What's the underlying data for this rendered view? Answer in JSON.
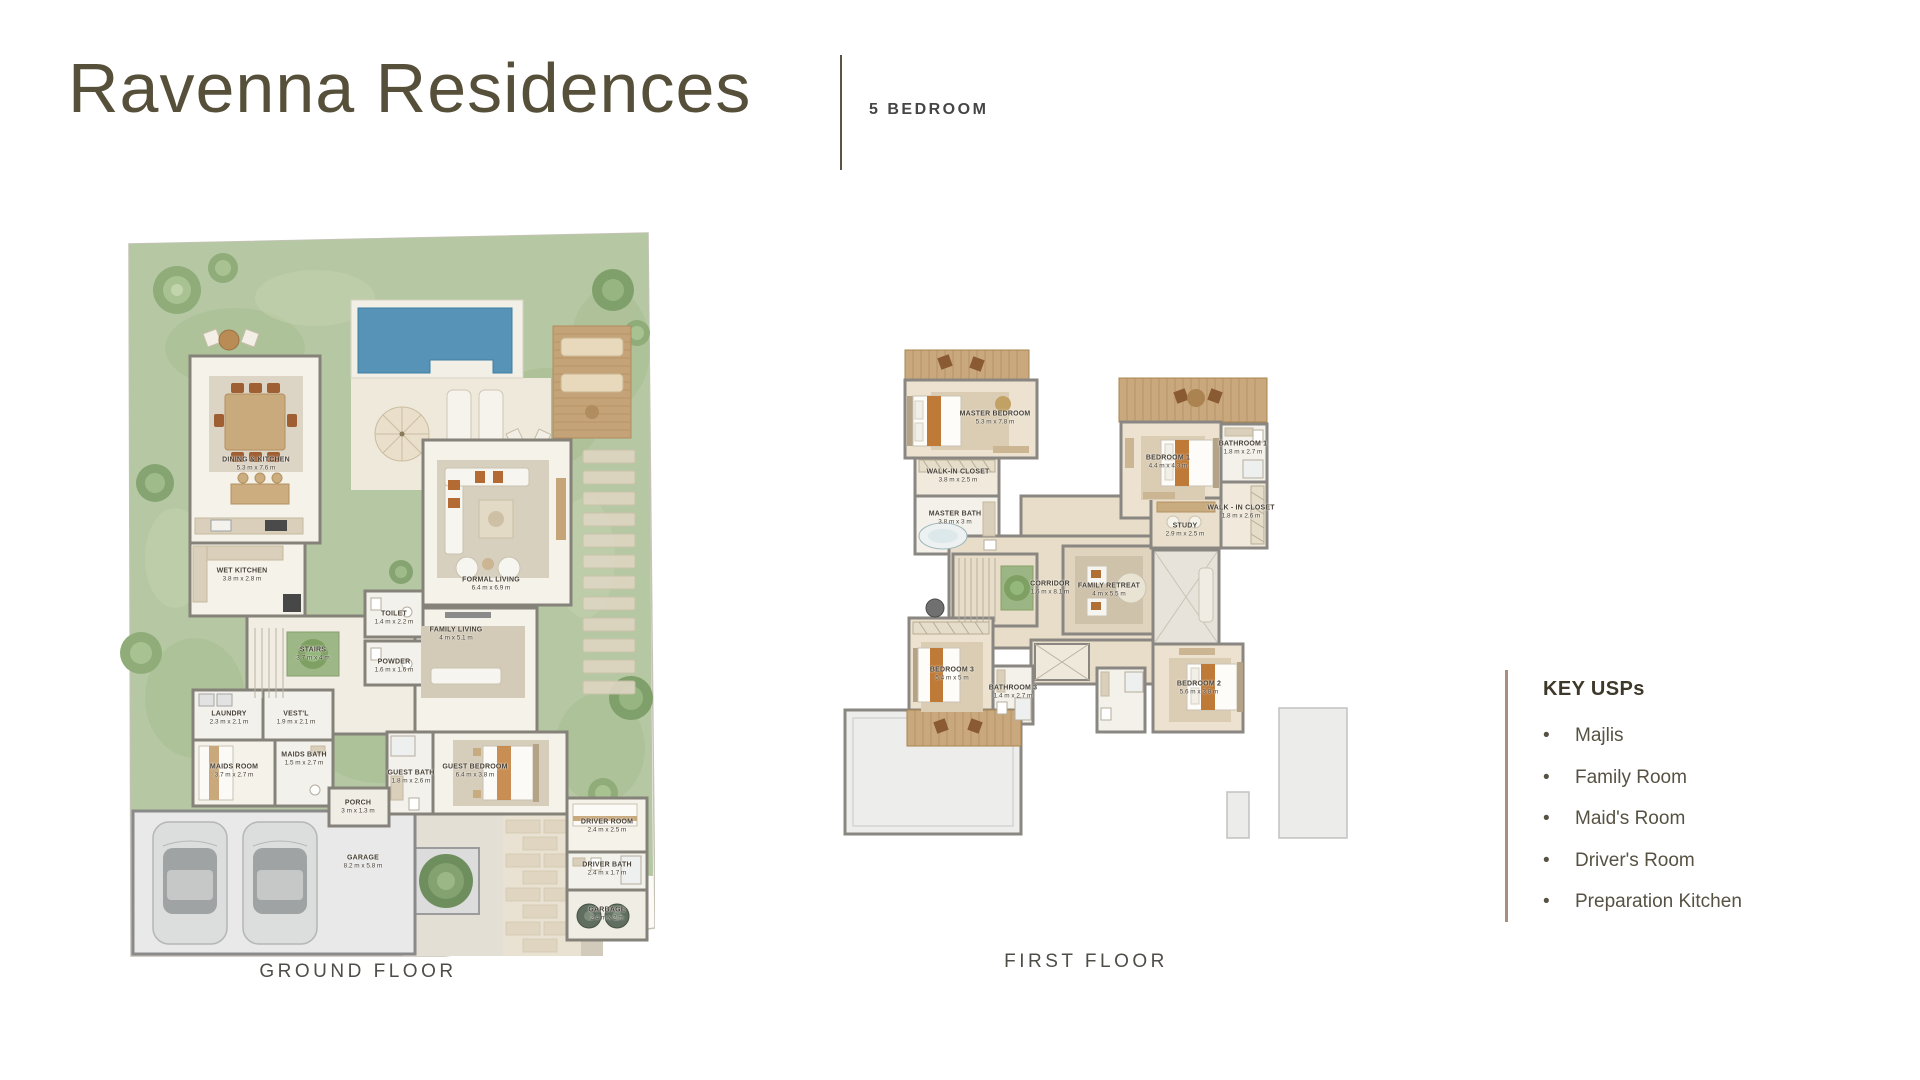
{
  "header": {
    "title": "Ravenna Residences",
    "unit_type": "5 BEDROOM"
  },
  "plans": {
    "ground": {
      "caption": "GROUND FLOOR",
      "rooms": [
        {
          "name": "DINING & KITCHEN",
          "dims": "5.3 m x 7.6 m"
        },
        {
          "name": "WET KITCHEN",
          "dims": "3.8 m x 2.8 m"
        },
        {
          "name": "STAIRS",
          "dims": "3.7 m x 4 m"
        },
        {
          "name": "TOILET",
          "dims": "1.4 m x 2.2 m"
        },
        {
          "name": "POWDER",
          "dims": "1.6 m x 1.6 m"
        },
        {
          "name": "FORMAL LIVING",
          "dims": "6.4 m x 6.9 m"
        },
        {
          "name": "FAMILY LIVING",
          "dims": "4 m x 5.1 m"
        },
        {
          "name": "LAUNDRY",
          "dims": "2.3 m x 2.1 m"
        },
        {
          "name": "VEST'L",
          "dims": "1.9 m x 2.1 m"
        },
        {
          "name": "MAIDS ROOM",
          "dims": "3.7 m x 2.7 m"
        },
        {
          "name": "MAIDS BATH",
          "dims": "1.5 m x 2.7 m"
        },
        {
          "name": "GUEST BATH",
          "dims": "1.8 m x 2.6 m"
        },
        {
          "name": "GUEST BEDROOM",
          "dims": "6.4 m x 3.8 m"
        },
        {
          "name": "PORCH",
          "dims": "3 m x 1.3 m"
        },
        {
          "name": "GARAGE",
          "dims": "8.2 m x 5.8 m"
        },
        {
          "name": "DRIVER ROOM",
          "dims": "2.4 m x 2.5 m"
        },
        {
          "name": "DRIVER BATH",
          "dims": "2.4 m x 1.7 m"
        },
        {
          "name": "GARBAGE",
          "dims": "2.4 m x 2 m"
        }
      ]
    },
    "first": {
      "caption": "FIRST FLOOR",
      "rooms": [
        {
          "name": "MASTER BEDROOM",
          "dims": "5.3 m x 7.8 m"
        },
        {
          "name": "WALK-IN CLOSET",
          "dims": "3.8 m x 2.5 m"
        },
        {
          "name": "MASTER BATH",
          "dims": "3.8 m x 3 m"
        },
        {
          "name": "BEDROOM 1",
          "dims": "4.4 m x 4.3 m"
        },
        {
          "name": "BATHROOM 1",
          "dims": "1.8 m x 2.7 m"
        },
        {
          "name": "WALK - IN CLOSET",
          "dims": "1.8 m x 2.6 m"
        },
        {
          "name": "STUDY",
          "dims": "2.9 m x 2.5 m"
        },
        {
          "name": "CORRIDOR",
          "dims": "1.6 m x 8.1 m"
        },
        {
          "name": "FAMILY RETREAT",
          "dims": "4 m x 5.5 m"
        },
        {
          "name": "BEDROOM 3",
          "dims": "5.4 m x 5 m"
        },
        {
          "name": "BATHROOM 3",
          "dims": "1.4 m x 2.7 m"
        },
        {
          "name": "BEDROOM 2",
          "dims": "5.6 m x 3.8 m"
        }
      ]
    }
  },
  "key_usps": {
    "heading": "KEY USPs",
    "items": [
      "Majlis",
      "Family Room",
      "Maid's Room",
      "Driver's Room",
      "Preparation Kitchen"
    ]
  },
  "colors": {
    "title_text": "#56503b",
    "accent_rule": "#a78e80",
    "garden_green": "#b6c8a3",
    "pool_blue": "#5693b7",
    "wall_gray": "#85827a",
    "wood_deck": "#c9a87e"
  }
}
